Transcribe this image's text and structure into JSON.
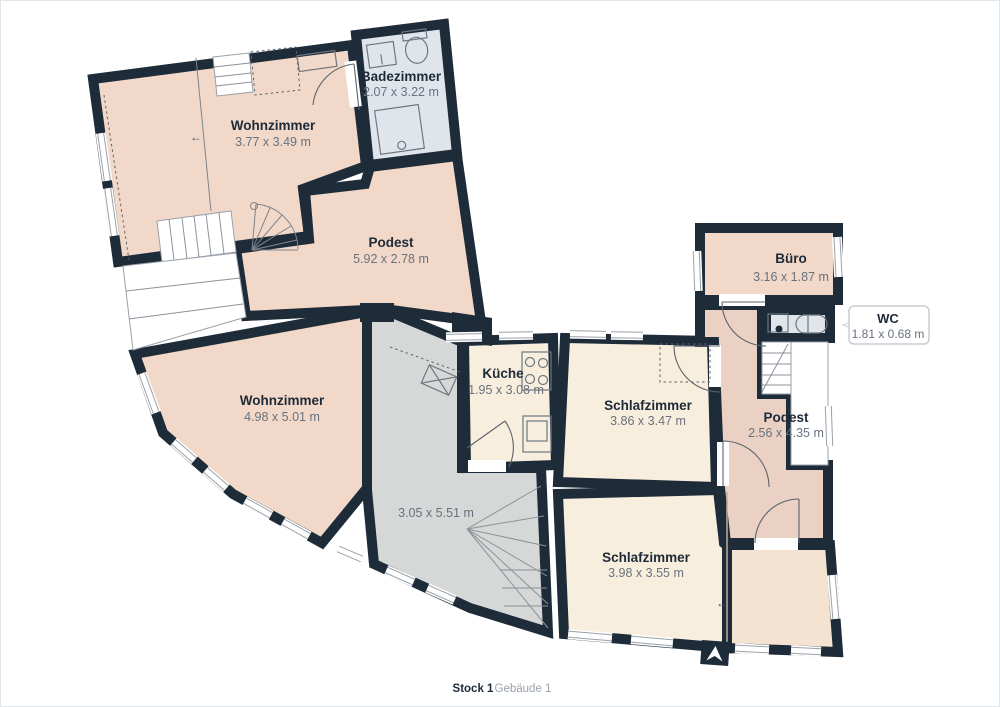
{
  "footer": {
    "floor_label": "Stock 1",
    "building_label": "Gebäude 1"
  },
  "icons": {
    "north_arrow": "north-arrow"
  },
  "colors": {
    "wall": "#1e2b39",
    "room_peach": "#f2d8c8",
    "room_peach_dark": "#ead1c3",
    "room_cream": "#f8eedd",
    "room_cream_dark": "#f4e3d1",
    "room_bath": "#e0e5ec",
    "room_gray": "#d6d7d7",
    "label_text": "#1d2a38",
    "dims_text": "#68727e",
    "callout_border": "#c9cdd3"
  },
  "rooms": [
    {
      "id": "badezimmer",
      "name": "Badezimmer",
      "dims": "2.07 x 3.22 m"
    },
    {
      "id": "wohnzimmer-top",
      "name": "Wohnzimmer",
      "dims": "3.77 x 3.49 m"
    },
    {
      "id": "podest-left",
      "name": "Podest",
      "dims": "5.92 x 2.78 m"
    },
    {
      "id": "wohnzimmer-left",
      "name": "Wohnzimmer",
      "dims": "4.98 x 5.01 m"
    },
    {
      "id": "kueche",
      "name": "Küche",
      "dims": "1.95 x 3.08 m"
    },
    {
      "id": "schlafzimmer-mid",
      "name": "Schlafzimmer",
      "dims": "3.86 x 3.47 m"
    },
    {
      "id": "buero",
      "name": "Büro",
      "dims": "3.16 x 1.87 m"
    },
    {
      "id": "wc",
      "name": "WC",
      "dims": "1.81 x 0.68 m"
    },
    {
      "id": "podest-right",
      "name": "Podest",
      "dims": "2.56 x 4.35 m"
    },
    {
      "id": "hall",
      "name": "",
      "dims": "3.05 x 5.51 m"
    },
    {
      "id": "schlafzimmer-bottom",
      "name": "Schlafzimmer",
      "dims": "3.98 x 3.55 m"
    }
  ]
}
